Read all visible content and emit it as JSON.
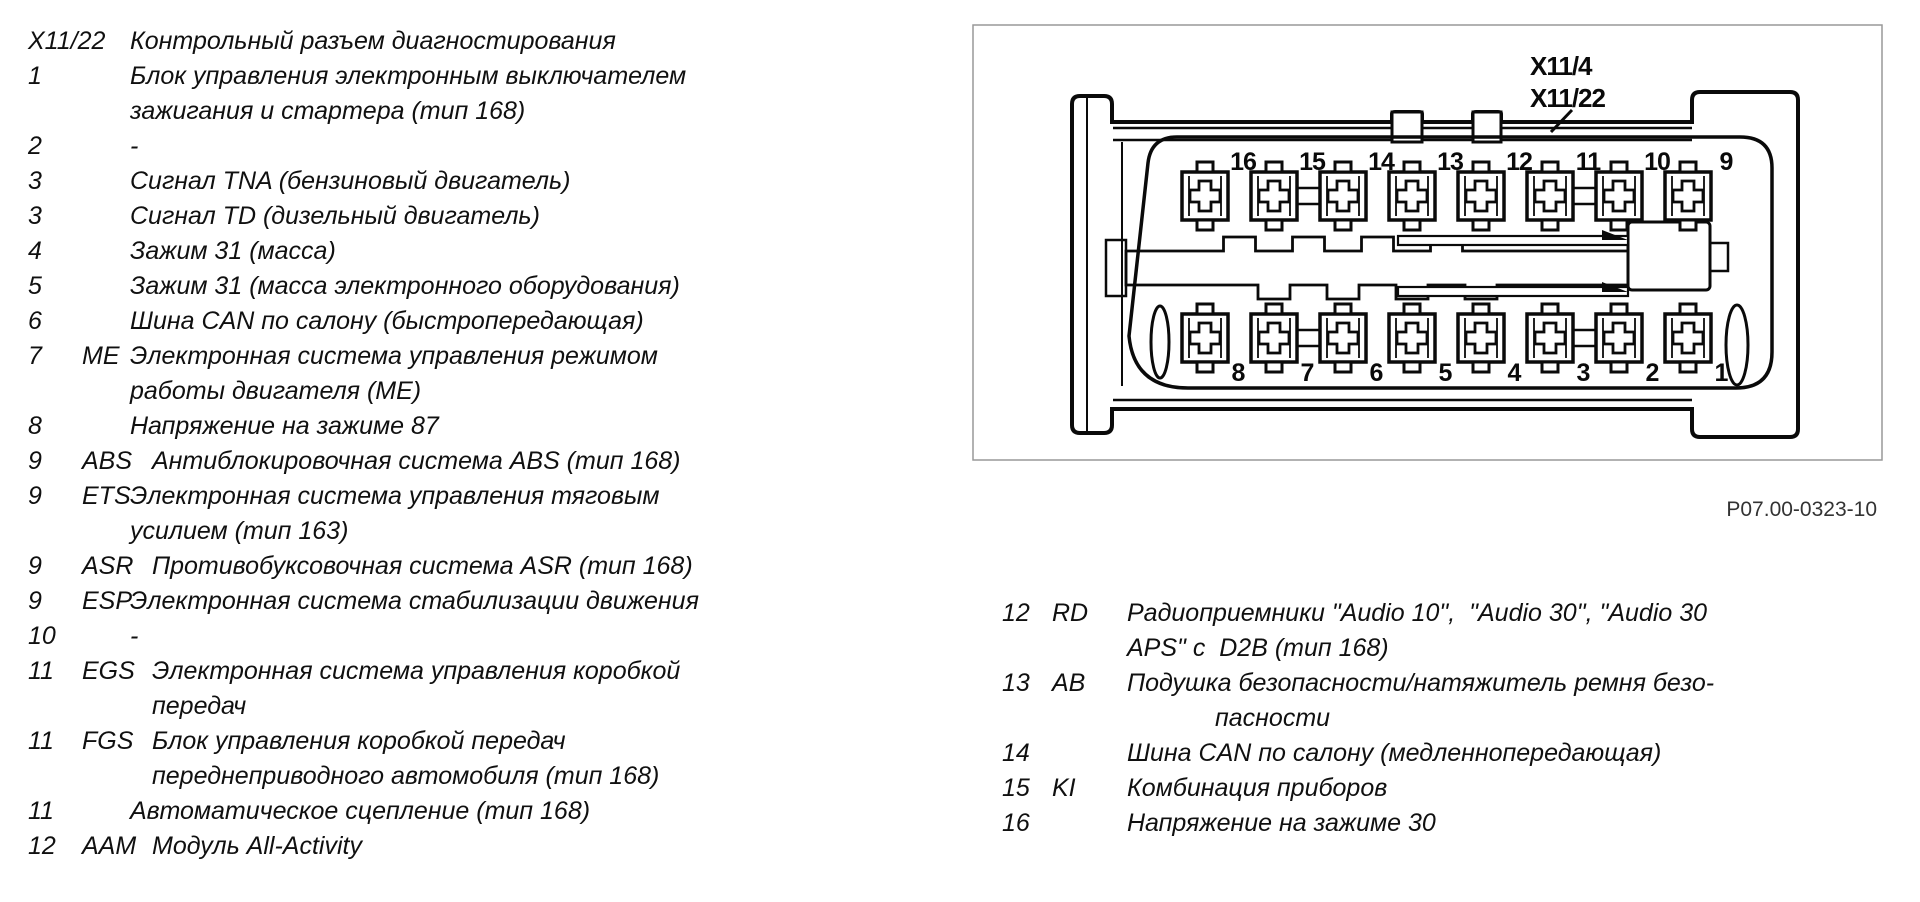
{
  "figure": {
    "caption": "P07.00-0323-10",
    "connector_labels": [
      "X11/4",
      "X11/22"
    ],
    "top_pin_numbers": [
      "16",
      "15",
      "14",
      "13",
      "12",
      "11",
      "10",
      "9"
    ],
    "bottom_pin_numbers": [
      "8",
      "7",
      "6",
      "5",
      "4",
      "3",
      "2",
      "1"
    ]
  },
  "left_list": {
    "lines": [
      {
        "num": "X11/22",
        "abbr": "",
        "text": "Контрольный разъем диагностирования",
        "indent": "n"
      },
      {
        "num": "1",
        "abbr": "",
        "text": "Блок управления электронным выключателем",
        "indent": "n"
      },
      {
        "num": "",
        "abbr": "",
        "text": "зажигания и стартера (тип 168)",
        "indent": "n"
      },
      {
        "num": "2",
        "abbr": "",
        "text": "-",
        "indent": "n"
      },
      {
        "num": "3",
        "abbr": "",
        "text": "Сигнал TNA (бензиновый двигатель)",
        "indent": "n"
      },
      {
        "num": "3",
        "abbr": "",
        "text": "Сигнал TD (дизельный двигатель)",
        "indent": "n"
      },
      {
        "num": "4",
        "abbr": "",
        "text": "Зажим 31 (масса)",
        "indent": "n"
      },
      {
        "num": "5",
        "abbr": "",
        "text": "Зажим 31 (масса электронного оборудования)",
        "indent": "n"
      },
      {
        "num": "6",
        "abbr": "",
        "text": "Шина CAN по салону (быстропередающая)",
        "indent": "n"
      },
      {
        "num": "7",
        "abbr": "ME",
        "text": "Электронная система управления режимом",
        "indent": "n"
      },
      {
        "num": "",
        "abbr": "",
        "text": "работы двигателя (МЕ)",
        "indent": "n"
      },
      {
        "num": "8",
        "abbr": "",
        "text": "Напряжение на зажиме 87",
        "indent": "n"
      },
      {
        "num": "9",
        "abbr": "ABS",
        "text": "Антиблокировочная система ABS (тип 168)",
        "indent": "w"
      },
      {
        "num": "9",
        "abbr": "ETS",
        "text": "Электронная система управления тяговым",
        "indent": "n"
      },
      {
        "num": "",
        "abbr": "",
        "text": "усилием (тип 163)",
        "indent": "n"
      },
      {
        "num": "9",
        "abbr": "ASR",
        "text": "Противобуксовочная система ASR (тип 168)",
        "indent": "w"
      },
      {
        "num": "9",
        "abbr": "ESP",
        "text": "Электронная система стабилизации движения",
        "indent": "n"
      },
      {
        "num": "10",
        "abbr": "",
        "text": "-",
        "indent": "n"
      },
      {
        "num": "11",
        "abbr": "EGS",
        "text": "Электронная система управления коробкой",
        "indent": "w"
      },
      {
        "num": "",
        "abbr": "",
        "text": "передач",
        "indent": "w"
      },
      {
        "num": "11",
        "abbr": "FGS",
        "text": "Блок управления коробкой передач",
        "indent": "w"
      },
      {
        "num": "",
        "abbr": "",
        "text": "переднеприводного автомобиля (тип 168)",
        "indent": "w"
      },
      {
        "num": "11",
        "abbr": "",
        "text": "Автоматическое сцепление (тип 168)",
        "indent": "n"
      },
      {
        "num": "12",
        "abbr": "AAM",
        "text": "Модуль All-Activity",
        "indent": "w"
      }
    ]
  },
  "right_list": {
    "lines": [
      {
        "num": "12",
        "abbr": "RD",
        "text": "Радиоприемники \"Audio 10\",  \"Audio 30\", \"Audio 30",
        "indent": "n"
      },
      {
        "num": "",
        "abbr": "",
        "text": "APS\" с  D2B (тип 168)",
        "indent": "n"
      },
      {
        "num": "13",
        "abbr": "AB",
        "text": "Подушка безопасности/натяжитель ремня безо-",
        "indent": "n"
      },
      {
        "num": "",
        "abbr": "",
        "text": "пасности",
        "indent": "d"
      },
      {
        "num": "14",
        "abbr": "",
        "text": "Шина CAN по салону (медленнопередающая)",
        "indent": "n"
      },
      {
        "num": "15",
        "abbr": "KI",
        "text": "Комбинация приборов",
        "indent": "n"
      },
      {
        "num": "16",
        "abbr": "",
        "text": "Напряжение на зажиме 30",
        "indent": "n"
      }
    ]
  }
}
